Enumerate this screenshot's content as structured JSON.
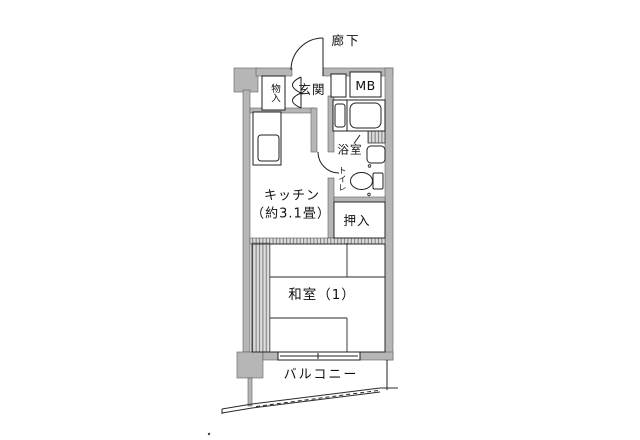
{
  "plan": {
    "type": "floor-plan",
    "labels": {
      "corridor": "廊下",
      "entrance": "玄関",
      "entrance_storage": "物入",
      "meter_box": "MB",
      "bathroom": "浴室",
      "toilet": "トイレ",
      "kitchen": "キッチン",
      "kitchen_size": "（約3.1畳）",
      "closet": "押入",
      "japanese_room": "和室（1）",
      "balcony": "バルコニー"
    },
    "fixtures": [
      "entrance-door-swing-arc",
      "entrance-storage-bifold-door",
      "kitchen-counter-with-sink",
      "bathtub",
      "wash-basin",
      "vanity-sink",
      "toilet-bowl-with-tank",
      "bathroom-door-swing-arc",
      "pipe-space-hatch",
      "tatami-grid",
      "sliding-fusuma-track",
      "balcony-sliding-window",
      "balcony-railing"
    ],
    "colors": {
      "wall": "#b6b6b6",
      "line": "#1f1f1f",
      "background": "#ffffff"
    }
  }
}
